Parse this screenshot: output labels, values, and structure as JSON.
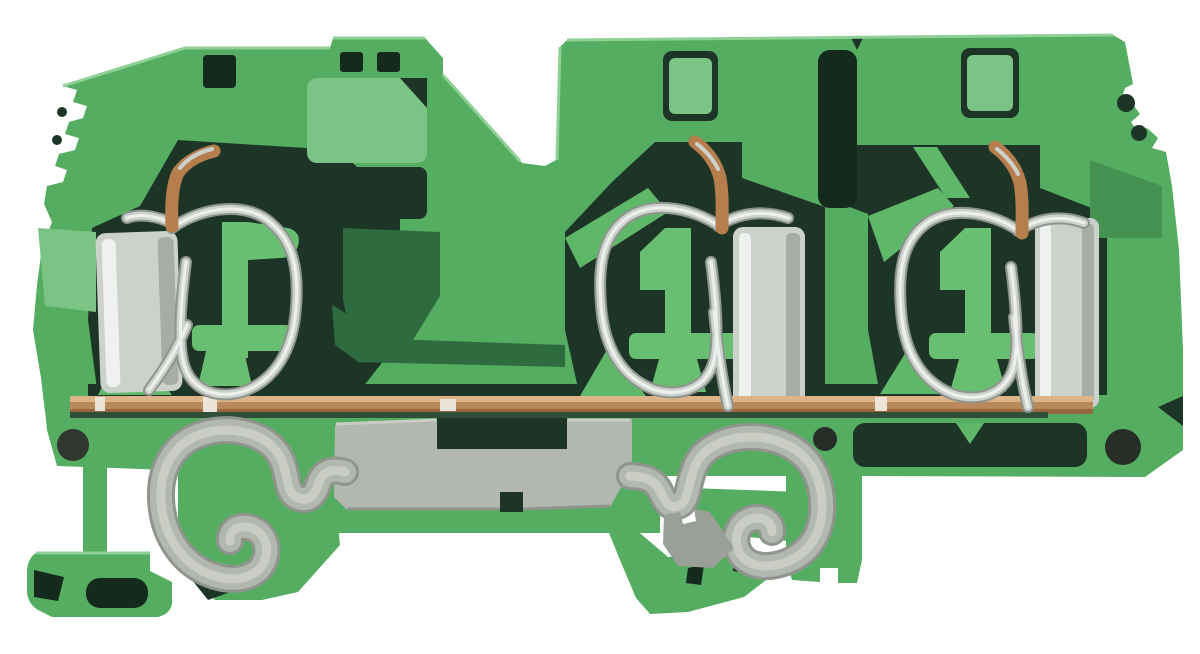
{
  "meta": {
    "kind": "product-photograph",
    "description": "Green 3-position spring-clamp (tension clamp) protective-earth DIN rail terminal block photographed on a white background",
    "width_px": 1200,
    "height_px": 654,
    "visible_text": ""
  },
  "subject": {
    "product": "PE spring terminal block",
    "clamp_positions": 3,
    "mount": "DIN rail foot with metal release latch",
    "parts": [
      "green molded housing",
      "three tension clamp springs",
      "three steel clamp plates",
      "copper busbar",
      "metal DIN-rail latch with pull eyelet",
      "snap-on feet",
      "test sockets"
    ]
  },
  "colors": {
    "background": "#ffffff",
    "green_face": "#54ad60",
    "green_light": "#5fb869",
    "green_pusher": "#68bf72",
    "green_pale": "#7cc386",
    "green_bevel": "#8ed096",
    "green_middark": "#2e6b3e",
    "green_panel": "#469253",
    "green_dark": "#1d3526",
    "green_deep": "#142a1d",
    "shadow_dark": "#2f4f38",
    "metal_light": "#eef1ee",
    "metal_main": "#ccd1cc",
    "metal_shade": "#a6ada6",
    "latch_main": "#b2b7af",
    "latch_light": "#c9cdc3",
    "latch_dark": "#8f958d",
    "latch_tab": "#9aa098",
    "spring_hi": "#eef0ee",
    "spring_mid": "#cdd2cd",
    "spring_dark": "#8e948e",
    "copper_main": "#b9895b",
    "copper_light": "#dcb488",
    "copper_dark": "#97683f",
    "copper_wire": "#b57e4c",
    "copper_glint": "#ece4d8",
    "hole_dark": "#30372f",
    "hole_darker": "#272e27"
  }
}
